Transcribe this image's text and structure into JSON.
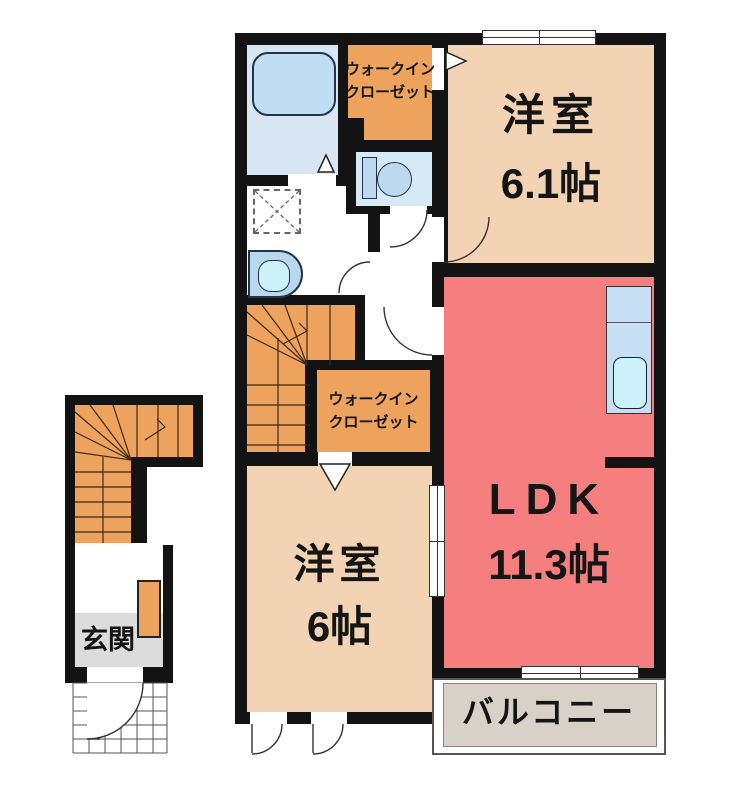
{
  "rooms": {
    "wic_top": {
      "label_line1": "ウォークイン",
      "label_line2": "クローゼット"
    },
    "bedroom_61": {
      "name": "洋室",
      "size": "6.1帖"
    },
    "ldk": {
      "name": "LDK",
      "size": "11.3帖"
    },
    "wic_mid": {
      "label_line1": "ウォークイン",
      "label_line2": "クローゼット"
    },
    "bedroom_6": {
      "name": "洋室",
      "size": "6帖"
    },
    "balcony": {
      "name": "バルコニー"
    },
    "entrance": {
      "name": "玄関"
    }
  },
  "colors": {
    "wall": "#131313",
    "room_peach": "#f2d3b3",
    "ldk_salmon": "#f57f7f",
    "closet_orange": "#eda25d",
    "bath_blue": "#d8e5f3",
    "fixture_blue": "#c0ddf4",
    "kitchen_counter_blue": "#c6dff4",
    "sink_cyan": "#cdf2fb",
    "balcony_gray": "#d7d2c8",
    "entrance_gray": "#dcdcdc"
  }
}
